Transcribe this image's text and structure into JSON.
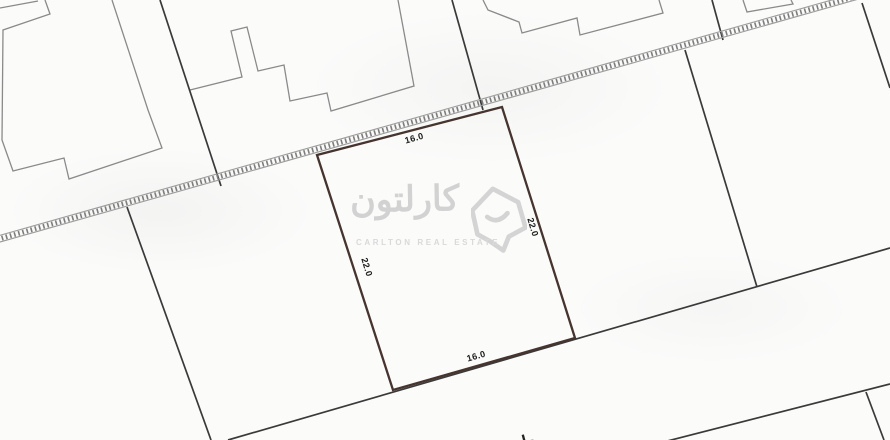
{
  "map": {
    "highlighted_plot": {
      "dimensions": {
        "top": "16.0",
        "bottom": "16.0",
        "left": "22.0",
        "right": "22.0"
      }
    },
    "road_label": "طريق",
    "colors": {
      "plot_outline": "#46342f",
      "boundary": "#3a3a3a",
      "building": "#8a8a8a",
      "hatch": "#7d7d7d",
      "label": "#1b1b1b",
      "background": "#fbfbfa",
      "watermark": "#d5d5d5"
    }
  },
  "watermark": {
    "brand_arabic": "كارلتون",
    "brand_english": "CARLTON REAL ESTATE",
    "logo": "carlton-house-logo"
  }
}
